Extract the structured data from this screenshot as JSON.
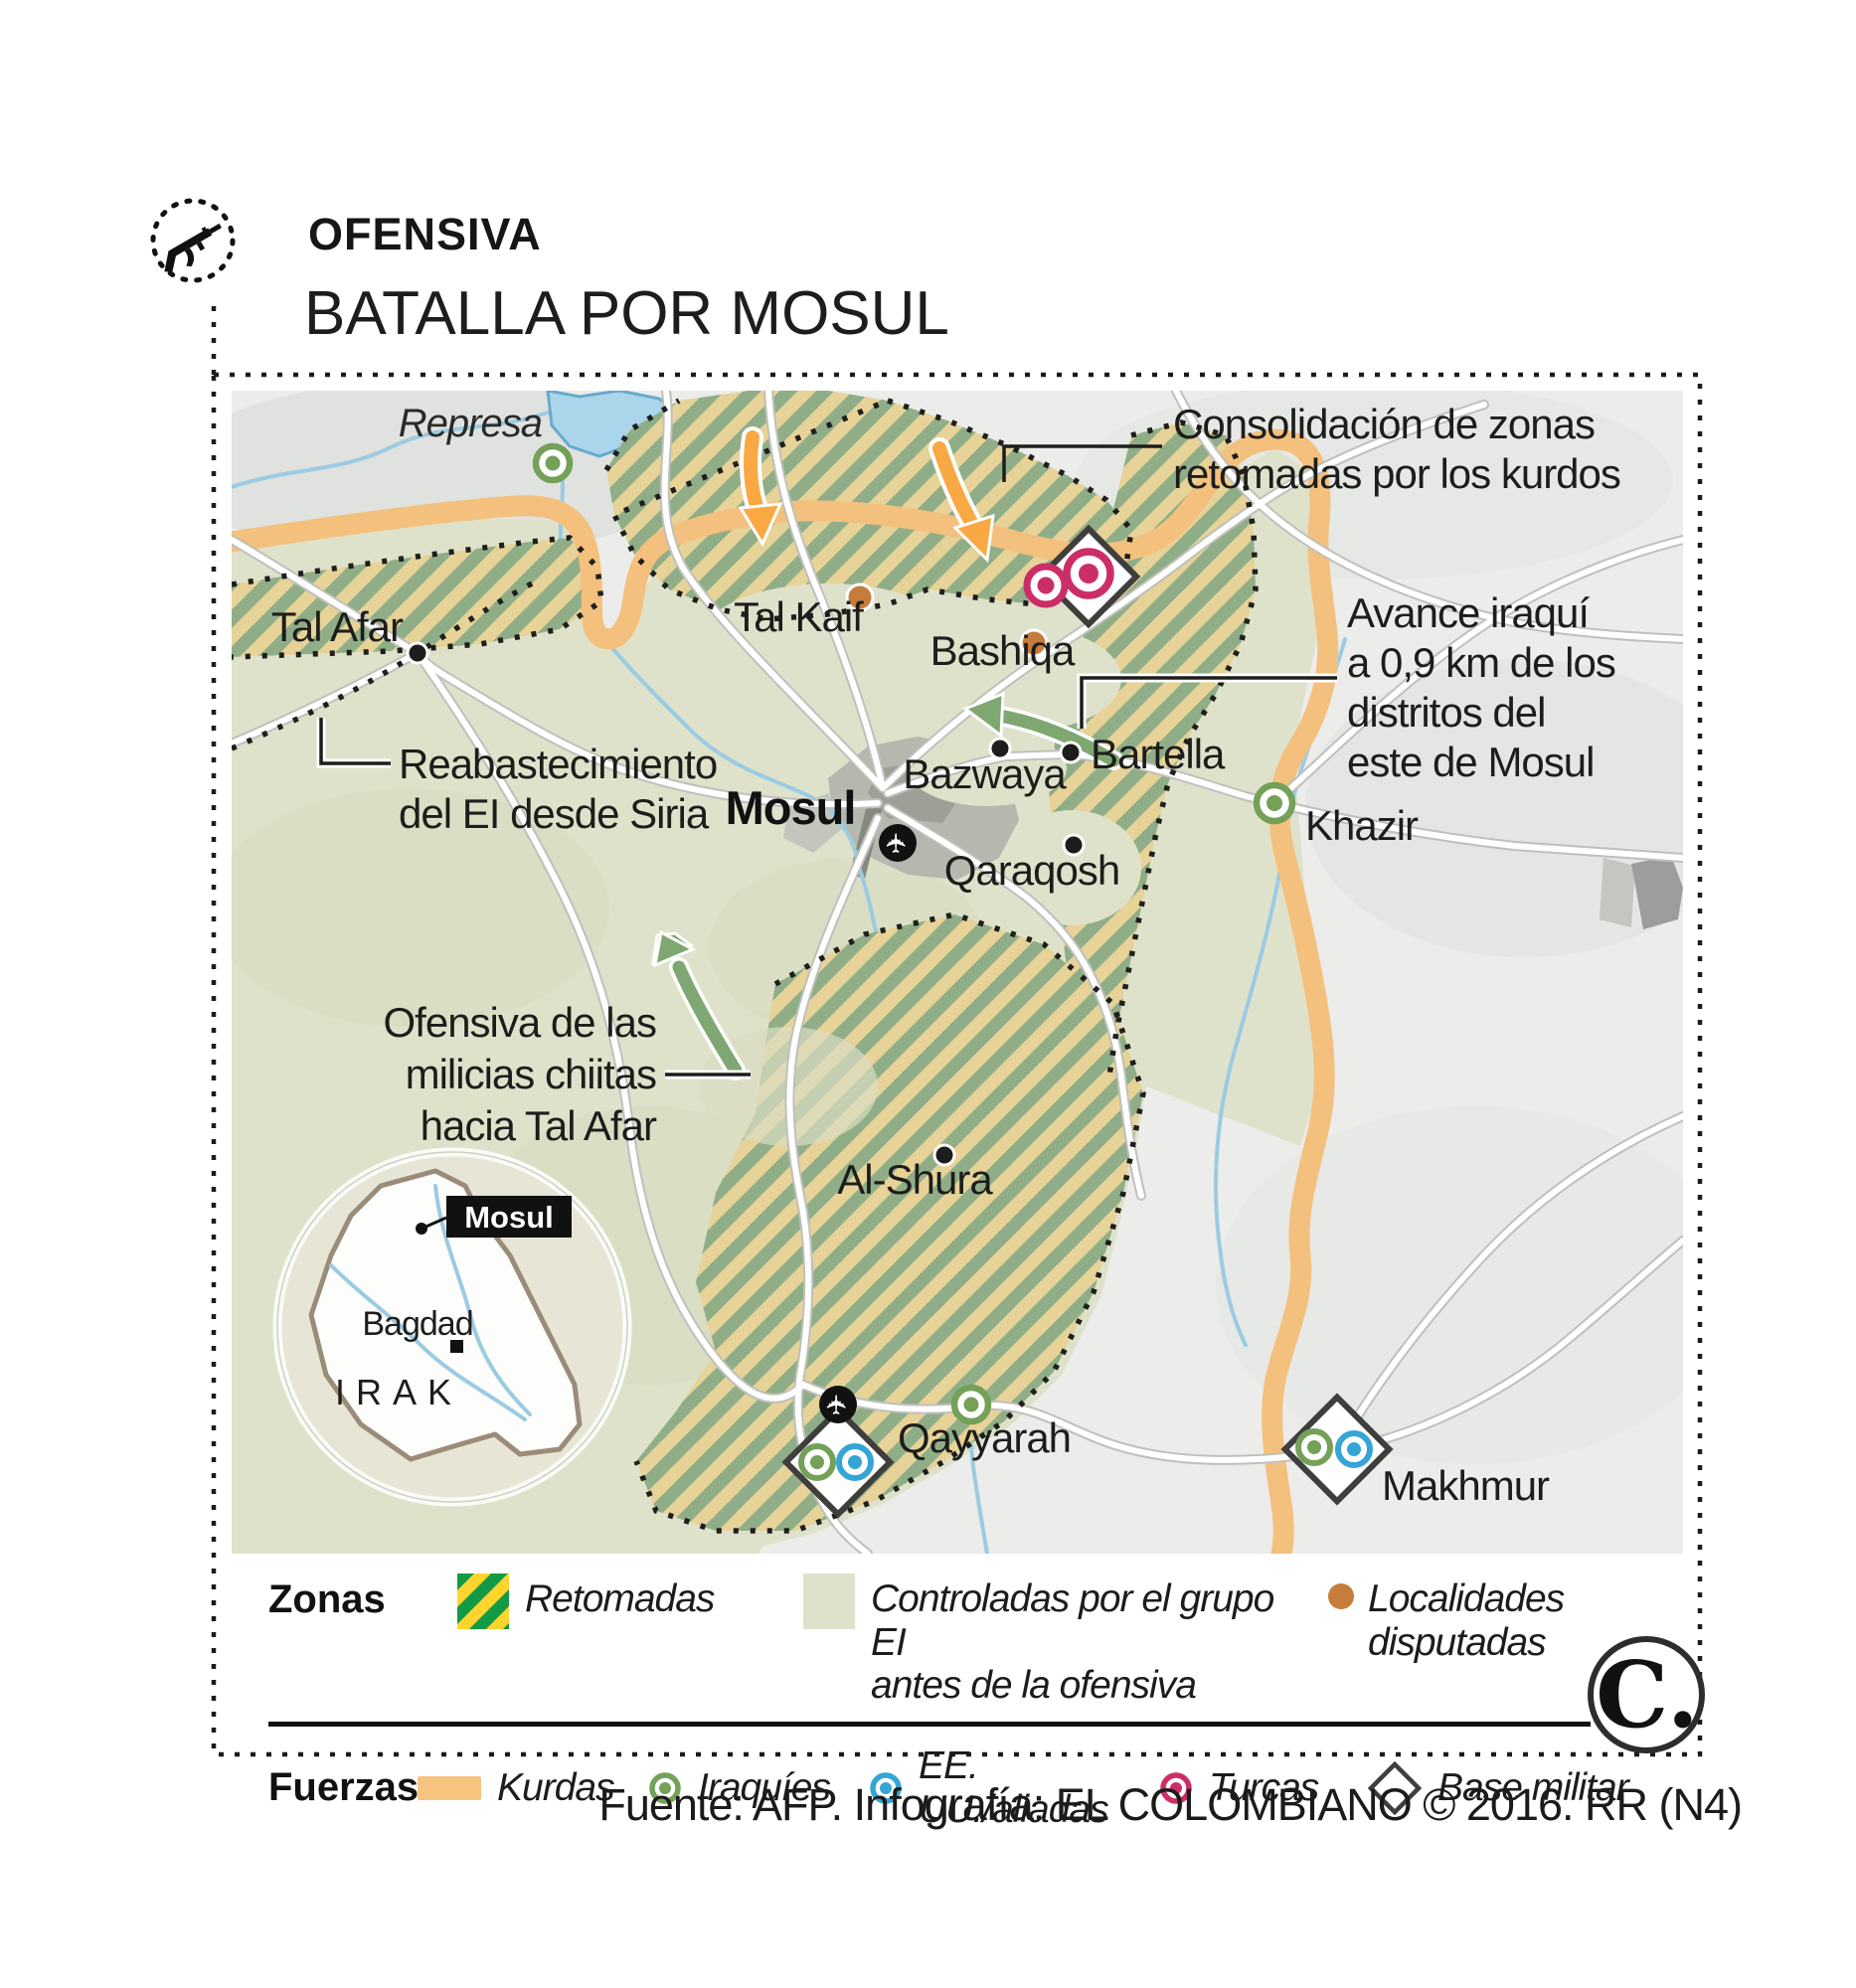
{
  "header": {
    "kicker": "OFENSIVA",
    "title": "BATALLA POR MOSUL"
  },
  "map": {
    "places": {
      "represa": "Represa",
      "tal_afar": "Tal Afar",
      "tal_kaif": "Tal Kaif",
      "bashiqa": "Bashiqa",
      "mosul": "Mosul",
      "bazwaya": "Bazwaya",
      "bartella": "Bartella",
      "khazir": "Khazir",
      "qaraqosh": "Qaraqosh",
      "al_shura": "Al-Shura",
      "qayyarah": "Qayyarah",
      "makhmur": "Makhmur"
    },
    "annotations": {
      "consolidacion": {
        "line1": "Consolidación de zonas",
        "line2": "retomadas por los kurdos"
      },
      "avance": {
        "line1": "Avance iraquí",
        "line2": "a 0,9 km de los",
        "line3": "distritos del",
        "line4": "este de Mosul"
      },
      "reabastecimiento": {
        "line1": "Reabastecimiento",
        "line2": "del EI desde Siria"
      },
      "ofensiva_milicias": {
        "line1": "Ofensiva de las",
        "line2": "milicias chiitas",
        "line3": "hacia Tal Afar"
      }
    },
    "inset": {
      "mosul": "Mosul",
      "bagdad": "Bagdad",
      "country": "IRAK"
    }
  },
  "legend": {
    "zonas_label": "Zonas",
    "retomadas": "Retomadas",
    "controladas_line1": "Controladas por el grupo EI",
    "controladas_line2": "antes de la ofensiva",
    "localidades_line1": "Localidades",
    "localidades_line2": "disputadas",
    "fuerzas_label": "Fuerzas",
    "kurdas": "Kurdas",
    "iraquies": "Iraquíes",
    "eeuu": "EE. UU./aliadas",
    "turcas": "Turcas",
    "base_militar": "Base militar"
  },
  "footer": {
    "credit": "Fuente: AFP. Infografía: EL COLOMBIANO © 2016. RR (N4)"
  },
  "logo": {
    "text": "C."
  },
  "colors": {
    "kurd_front": "#f4c07d",
    "orange_arrow": "#f9a843",
    "green_arrow": "#7fa771",
    "ei_zone": "#dfe2cb",
    "hatch_green_map": "#8fae88",
    "hatch_tan_map": "#e7d298",
    "hatch_green_legend": "#139a47",
    "hatch_yellow_legend": "#ffd42d",
    "iraqi_icon": "#74a058",
    "us_icon": "#35a5d5",
    "turkish_icon": "#cb2e67",
    "disputed_dot": "#c67c3a",
    "lake": "#abd5ea"
  }
}
